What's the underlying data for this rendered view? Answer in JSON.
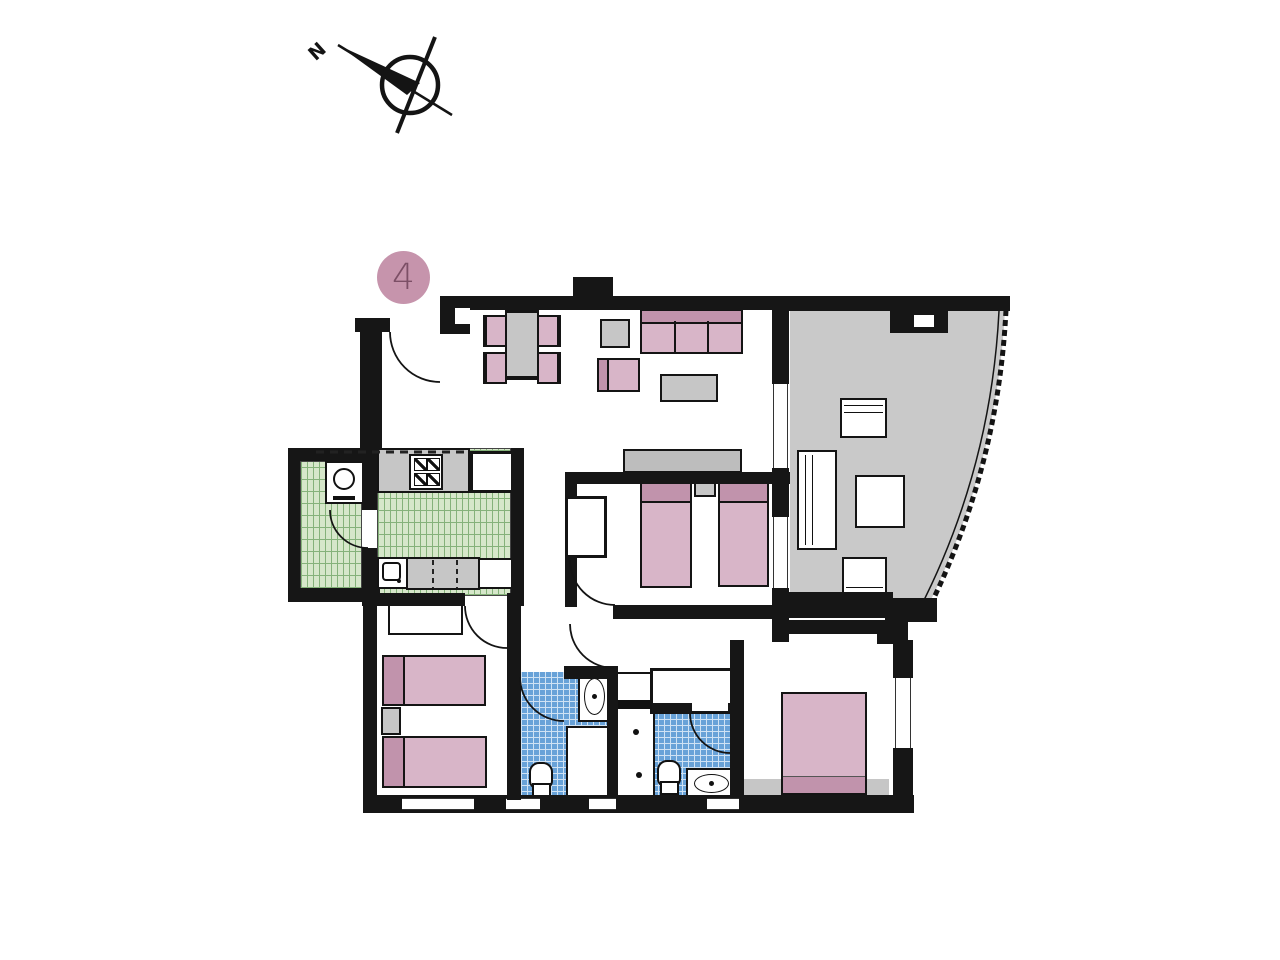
{
  "unit_badge": {
    "number": "4"
  },
  "compass": {
    "label": "N"
  },
  "palette": {
    "wall": "#161616",
    "pink": "#d8b5c8",
    "pink_dark": "#c193ac",
    "badge_bg": "#c694ac",
    "badge_text": "#7c4f66",
    "gray_furn": "#c6c6c6",
    "sideboard": "#bdbdbd",
    "terrace_floor": "#c9c9c9",
    "green_tile": "#d6e7ca",
    "green_line": "#85b27a",
    "blue_tile": "#68a2d8",
    "blue_line": "#cfe2f4"
  }
}
